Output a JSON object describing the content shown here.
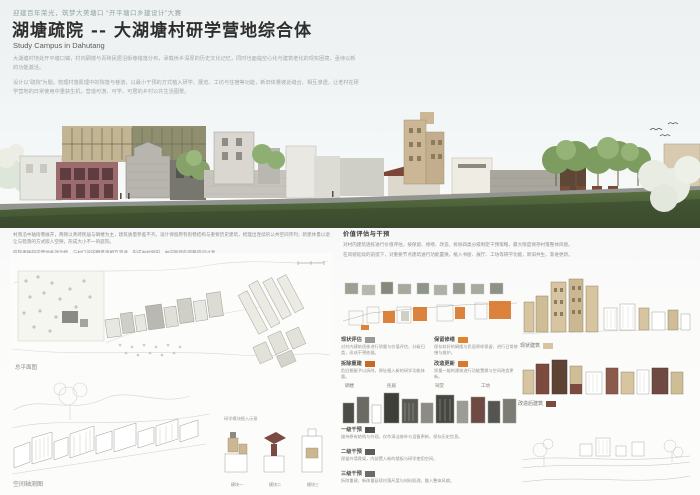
{
  "header": {
    "tagline": "迎建百年荣光，筑梦大美塘口 “开平塘口乡建设计”大赛",
    "title": "湖塘疏院 -- 大湖塘村研学营地综合体",
    "subtitle": "Study Campus in Dahutang"
  },
  "intro": {
    "p1": "大湖塘村地处开平塘口镇，村内碉楼与青砖民居沿街巷错落分布，承载侨乡深厚的历史文化记忆，同时也面临空心化与建筑老化的现实困境，亟待以新的功能激活。",
    "p2": "设计以“疏院”为题，梳理村落肌理中的院落与巷道，以最小干预的方式植入研学、展览、工坊与住宿等功能，新旧体量彼此缝合、相互渗透，让老村在研学营地的日常使用中重获生机，营造可游、可学、可居的乡村公共生活图景。"
  },
  "analysis": {
    "left_p1": "村落沿中轴街巷展开，两侧以青砖民居与碉楼为主，建筑质量参差不齐。设计保留原有街巷结构与重要历史建筑，梳理出连续的公共空间序列；新建体量以退让与错落的方式嵌入空隙，形成大小不一的庭院。",
    "left_p2": "庭院串联研学营地各项功能，与村口的田野景观相互渗透，形成由村到田、由旧到新的完整空间过渡。",
    "right_heading": "价值评估与干预",
    "right_p1": "对村内建筑逐栋进行价值评估，按保留、修缮、改造、拆除四类分级制定干预策略，最大限度保存村落整体风貌。",
    "right_p2": "在风貌延续的前提下，对重要节点建筑进行功能置换，植入书屋、展厅、工坊等研学功能，新旧共生、渐进更新。"
  },
  "site_plan": {
    "caption": "总平面图"
  },
  "axon": {
    "caption": "空间轴测图",
    "note": "研学模块植入示意",
    "modules": [
      {
        "label": "模块一"
      },
      {
        "label": "模块二"
      },
      {
        "label": "模块三"
      }
    ]
  },
  "strategy": {
    "legend1": [
      {
        "label": "现状评估",
        "swatch": "#9a9a94",
        "desc": "对村内建筑逐栋进行质量与价值评估，分级归类，形成干预依据。"
      },
      {
        "label": "保留修缮",
        "swatch": "#e0832f",
        "desc": "保存较好的碉楼与民居原样保留，进行日常修缮与维护。"
      },
      {
        "label": "拆除重建",
        "swatch": "#c96a24",
        "desc": "危旧棚屋予以拆除，原址植入新的研学功能体量。"
      },
      {
        "label": "改造更新",
        "swatch": "#d9782e",
        "desc": "质量一般的建筑进行功能置换与空间改造更新。"
      }
    ],
    "row2_labels": [
      "碉楼",
      "民居",
      "祠堂",
      "工坊"
    ],
    "legend2": [
      {
        "label": "一级干预",
        "swatch": "#4c4c48",
        "desc": "维持原有结构与外观，仅作清洁修补与设备更新，保存历史信息。"
      },
      {
        "label": "二级干预",
        "swatch": "#5c5c58",
        "desc": "保留外墙骨架，内部置入新的楼板与研学使用空间。"
      },
      {
        "label": "三级干预",
        "swatch": "#6c6c68",
        "desc": "拆除重建，新体量延续村落尺度与材料肌理，融入整体风貌。"
      }
    ]
  },
  "right_col": {
    "strip1_caption": "现状建筑",
    "strip1_swatch": "#d6c5a0",
    "strip2_caption": "改造后建筑",
    "strip2_swatch": "#7d4a3f"
  },
  "colors": {
    "accent_orange": "#d9782e",
    "tan": "#d6c59f",
    "maroon": "#9c6b6e",
    "olive": "#8f8f70",
    "grass_green": "#4d5f3c"
  }
}
